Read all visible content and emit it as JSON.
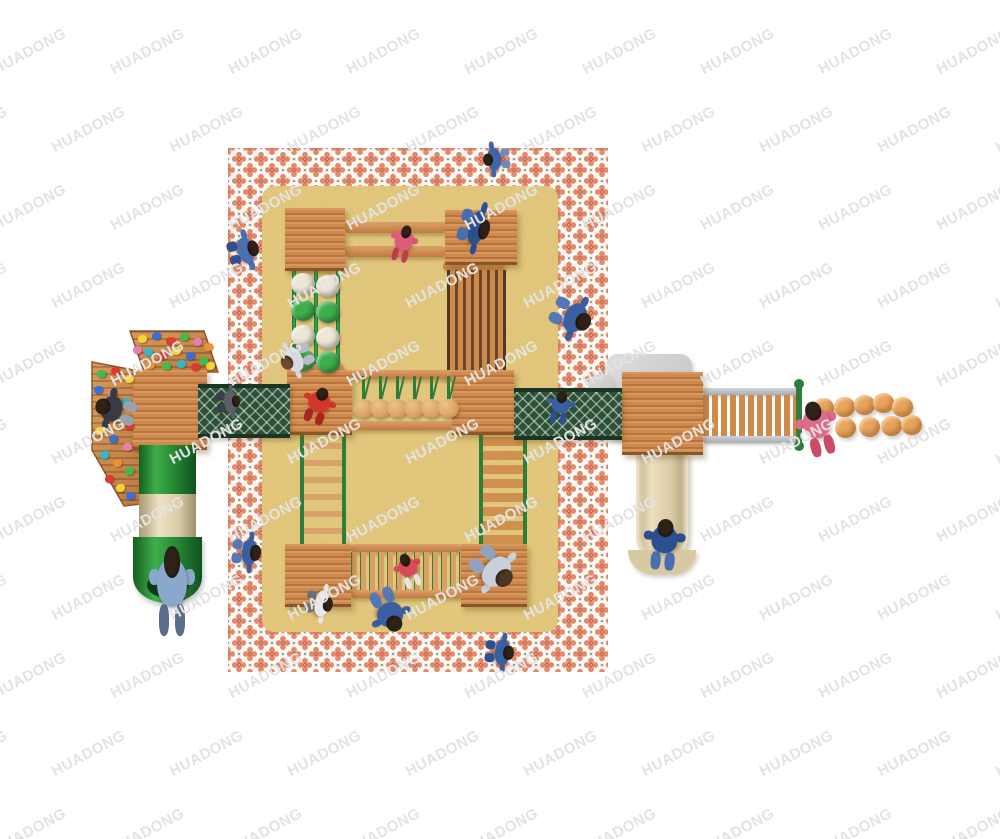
{
  "watermark": {
    "text": "HUADONG",
    "color": "#e3e3e3",
    "font_size": 15,
    "rotation": -28,
    "x_step": 118,
    "y_step": 78,
    "row_offset": 59
  },
  "palette": {
    "wood": "#cd8a4e",
    "wood_edge": "#8a5527",
    "green": "#3fae4c",
    "mesh": "#2d5038",
    "sand": "#e7ca80",
    "rug_motif": "#e18a6b",
    "rug_center": "#c55f45",
    "rug_dot": "#85a89f",
    "ball": "#e8a45c",
    "pod": "#d9a362",
    "wm_color": "#e3e3e3"
  },
  "climbing_holds": [
    {
      "x": 142,
      "y": 339,
      "c": "#f3d23a"
    },
    {
      "x": 156,
      "y": 336,
      "c": "#3a6fd8"
    },
    {
      "x": 170,
      "y": 341,
      "c": "#e23b2e"
    },
    {
      "x": 184,
      "y": 337,
      "c": "#43b94e"
    },
    {
      "x": 197,
      "y": 342,
      "c": "#e87fb4"
    },
    {
      "x": 208,
      "y": 347,
      "c": "#f09030"
    },
    {
      "x": 148,
      "y": 352,
      "c": "#35b8c8"
    },
    {
      "x": 162,
      "y": 356,
      "c": "#e23b2e"
    },
    {
      "x": 176,
      "y": 351,
      "c": "#f3d23a"
    },
    {
      "x": 190,
      "y": 356,
      "c": "#3a6fd8"
    },
    {
      "x": 203,
      "y": 361,
      "c": "#43b94e"
    },
    {
      "x": 137,
      "y": 350,
      "c": "#e87fb4"
    },
    {
      "x": 150,
      "y": 365,
      "c": "#f09030"
    },
    {
      "x": 166,
      "y": 366,
      "c": "#43b94e"
    },
    {
      "x": 181,
      "y": 364,
      "c": "#35b8c8"
    },
    {
      "x": 195,
      "y": 367,
      "c": "#e23b2e"
    },
    {
      "x": 210,
      "y": 366,
      "c": "#f3d23a"
    },
    {
      "x": 101,
      "y": 374,
      "c": "#43b94e"
    },
    {
      "x": 115,
      "y": 371,
      "c": "#e23b2e"
    },
    {
      "x": 129,
      "y": 379,
      "c": "#f3d23a"
    },
    {
      "x": 98,
      "y": 390,
      "c": "#3a6fd8"
    },
    {
      "x": 112,
      "y": 395,
      "c": "#e87fb4"
    },
    {
      "x": 126,
      "y": 402,
      "c": "#35b8c8"
    },
    {
      "x": 102,
      "y": 411,
      "c": "#f09030"
    },
    {
      "x": 116,
      "y": 418,
      "c": "#43b94e"
    },
    {
      "x": 129,
      "y": 426,
      "c": "#e23b2e"
    },
    {
      "x": 99,
      "y": 431,
      "c": "#f3d23a"
    },
    {
      "x": 113,
      "y": 439,
      "c": "#3a6fd8"
    },
    {
      "x": 127,
      "y": 447,
      "c": "#e87fb4"
    },
    {
      "x": 104,
      "y": 455,
      "c": "#35b8c8"
    },
    {
      "x": 117,
      "y": 463,
      "c": "#f09030"
    },
    {
      "x": 129,
      "y": 471,
      "c": "#43b94e"
    },
    {
      "x": 109,
      "y": 479,
      "c": "#e23b2e"
    },
    {
      "x": 120,
      "y": 488,
      "c": "#f3d23a"
    },
    {
      "x": 130,
      "y": 496,
      "c": "#3a6fd8"
    }
  ],
  "discs": [
    {
      "x": 303,
      "y": 284,
      "c": "#ece7d6"
    },
    {
      "x": 328,
      "y": 286,
      "c": "#ece7d6"
    },
    {
      "x": 303,
      "y": 310,
      "c": "#3fae4c"
    },
    {
      "x": 328,
      "y": 312,
      "c": "#3fae4c"
    },
    {
      "x": 303,
      "y": 336,
      "c": "#ece7d6"
    },
    {
      "x": 328,
      "y": 338,
      "c": "#ece7d6"
    },
    {
      "x": 303,
      "y": 360,
      "c": "#3fae4c"
    },
    {
      "x": 328,
      "y": 362,
      "c": "#3fae4c"
    }
  ],
  "pods": [
    {
      "x": 362
    },
    {
      "x": 379
    },
    {
      "x": 396
    },
    {
      "x": 413
    },
    {
      "x": 430
    },
    {
      "x": 447
    }
  ],
  "stepping_balls": [
    {
      "x": 823,
      "y": 408
    },
    {
      "x": 844,
      "y": 407
    },
    {
      "x": 864,
      "y": 405
    },
    {
      "x": 883,
      "y": 403
    },
    {
      "x": 902,
      "y": 407
    },
    {
      "x": 845,
      "y": 428
    },
    {
      "x": 869,
      "y": 427
    },
    {
      "x": 891,
      "y": 426
    },
    {
      "x": 911,
      "y": 425
    }
  ],
  "figures": [
    {
      "x": 480,
      "y": 146,
      "w": 34,
      "h": 26,
      "rot": -95,
      "shirt": "#3d66a8",
      "pants": "#7388b4"
    },
    {
      "x": 223,
      "y": 236,
      "w": 40,
      "h": 30,
      "rot": 75,
      "shirt": "#4a6fb0",
      "pants": "#33508c"
    },
    {
      "x": 448,
      "y": 212,
      "w": 52,
      "h": 30,
      "rot": 105,
      "shirt": "#2c4f92",
      "pants": "#4a6fb0"
    },
    {
      "x": 390,
      "y": 226,
      "w": 26,
      "h": 36,
      "rot": 15,
      "shirt": "#e05a7a",
      "pants": "#c03a55"
    },
    {
      "x": 548,
      "y": 296,
      "w": 46,
      "h": 40,
      "rot": 115,
      "shirt": "#3a5fa0",
      "pants": "#5577b5"
    },
    {
      "x": 278,
      "y": 342,
      "w": 38,
      "h": 32,
      "rot": -115,
      "shirt": "#d8d8e2",
      "pants": "#b8bcc8",
      "hair": "#6b4a2e"
    },
    {
      "x": 302,
      "y": 388,
      "w": 32,
      "h": 36,
      "rot": 20,
      "shirt": "#d3362c",
      "pants": "#a82520"
    },
    {
      "x": 212,
      "y": 390,
      "w": 32,
      "h": 24,
      "rot": 85,
      "shirt": "#5a5f66",
      "pants": "#3a3f48"
    },
    {
      "x": 546,
      "y": 392,
      "w": 28,
      "h": 32,
      "rot": 10,
      "shirt": "#3a5fa0",
      "pants": "#2c4f92"
    },
    {
      "x": 396,
      "y": 554,
      "w": 26,
      "h": 34,
      "rot": -20,
      "shirt": "#d84a5a",
      "pants": "#e8e4e0"
    },
    {
      "x": 468,
      "y": 546,
      "w": 50,
      "h": 44,
      "rot": 130,
      "shirt": "#c8d0dc",
      "pants": "#8fa3c0",
      "hair": "#4a3624"
    },
    {
      "x": 226,
      "y": 538,
      "w": 40,
      "h": 28,
      "rot": 95,
      "shirt": "#3a5fa0",
      "pants": "#5577b5"
    },
    {
      "x": 300,
      "y": 590,
      "w": 38,
      "h": 26,
      "rot": 100,
      "shirt": "#e8e8ee",
      "pants": "#6a6f78"
    },
    {
      "x": 368,
      "y": 588,
      "w": 40,
      "h": 44,
      "rot": 155,
      "shirt": "#3a5fa0",
      "pants": "#5577b5"
    },
    {
      "x": 480,
      "y": 638,
      "w": 38,
      "h": 28,
      "rot": 95,
      "shirt": "#3a5fa0",
      "pants": "#2c4f92"
    },
    {
      "x": 150,
      "y": 548,
      "w": 44,
      "h": 88,
      "rot": 0,
      "shirt": "#8aa8cc",
      "pants": "#5a6e8c"
    },
    {
      "x": 644,
      "y": 520,
      "w": 40,
      "h": 50,
      "rot": 5,
      "shirt": "#2c4f92",
      "pants": "#4a6fb0"
    },
    {
      "x": 798,
      "y": 402,
      "w": 40,
      "h": 54,
      "rot": -15,
      "shirt": "#e06a8a",
      "pants": "#cc4a66"
    },
    {
      "x": 96,
      "y": 390,
      "w": 40,
      "h": 40,
      "rot": -75,
      "shirt": "#3a3a44",
      "pants": "#9aa0ac"
    }
  ]
}
